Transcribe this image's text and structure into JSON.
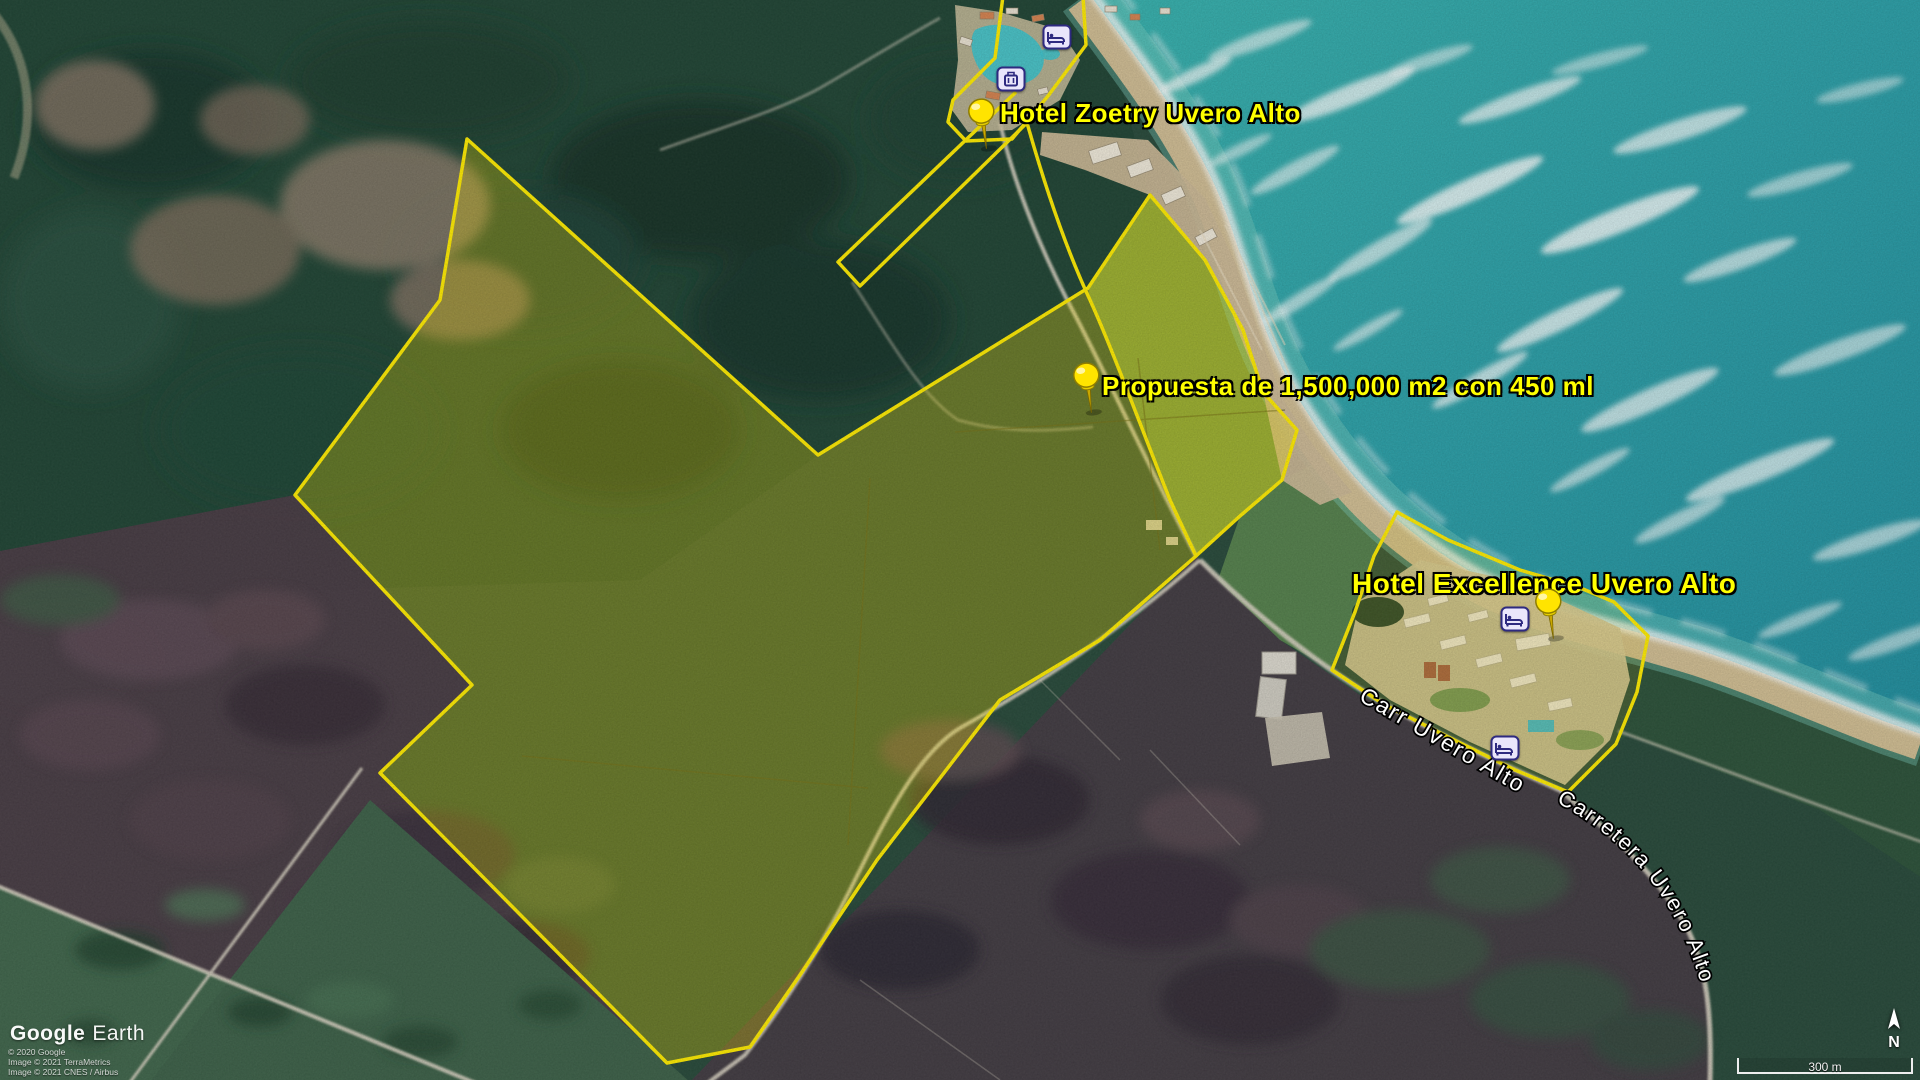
{
  "app": {
    "logo_word1": "Google",
    "logo_word2": "Earth"
  },
  "attribution": {
    "lines": [
      "© 2020 Google",
      "Image © 2021 TerraMetrics",
      "Image © 2021 CNES / Airbus"
    ]
  },
  "placemarks": [
    {
      "id": "zoetry",
      "label": "Hotel Zoetry Uvero Alto"
    },
    {
      "id": "propuesta",
      "label": "Propuesta de 1,500,000 m2 con 450 ml"
    },
    {
      "id": "excellence",
      "label": "Hotel Excellence Uvero Alto"
    }
  ],
  "road_labels": [
    {
      "label": "Carr Uvero Alto"
    },
    {
      "label": "Carretera Uvero Alto"
    }
  ],
  "icons": [
    "yellow-pushpin-icon",
    "lodging-bed-icon",
    "luggage-icon",
    "north-arrow-icon"
  ],
  "colors": {
    "overlay_outline": "#ffec00",
    "overlay_fill": "rgba(255,232,0,0.30)",
    "placemark_label": "#ffff00",
    "road_label": "#ffffff",
    "ocean": "#27a3a8",
    "beach": "#d8c196"
  },
  "scale_bar": {
    "label": "300 m"
  },
  "compass": {
    "label": "N"
  }
}
